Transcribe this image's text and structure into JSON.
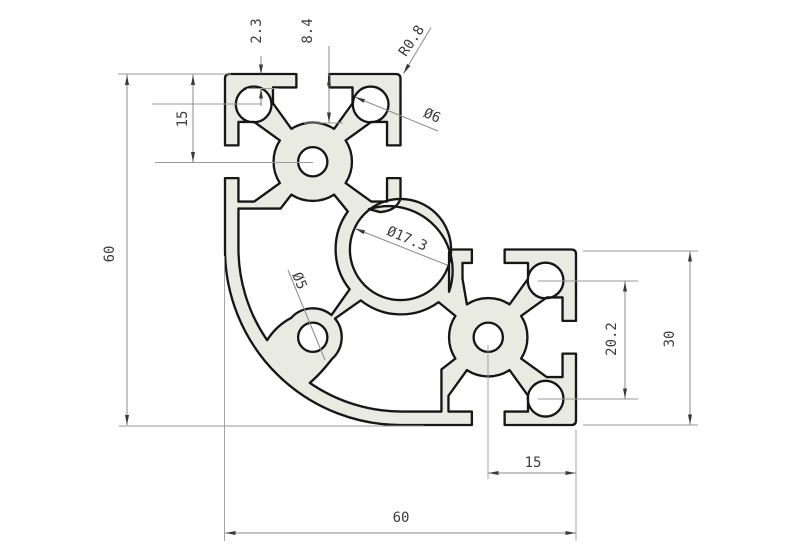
{
  "drawing": {
    "type": "technical-cad-drawing",
    "subject": "aluminum-extrusion-corner-profile-cross-section",
    "dims": {
      "lip_thickness": "2.3",
      "slot_depth": "8.4",
      "corner_radius": "R0.8",
      "corner_hole_dia": "Ø6",
      "slot_center_offset_left": "15",
      "overall_height": "60",
      "center_bore_dia": "Ø17.3",
      "diagonal_hole_dia": "Ø5",
      "hole_spacing_right": "20.2",
      "block_size_right": "30",
      "hole_edge_offset_bottom": "15",
      "overall_width": "60"
    },
    "colors": {
      "profile_fill": "#e9ebe3",
      "outline": "#161616",
      "dimension_lines": "#8a8a8a",
      "dimension_text": "#3c3c3c",
      "background": "#ffffff"
    }
  }
}
